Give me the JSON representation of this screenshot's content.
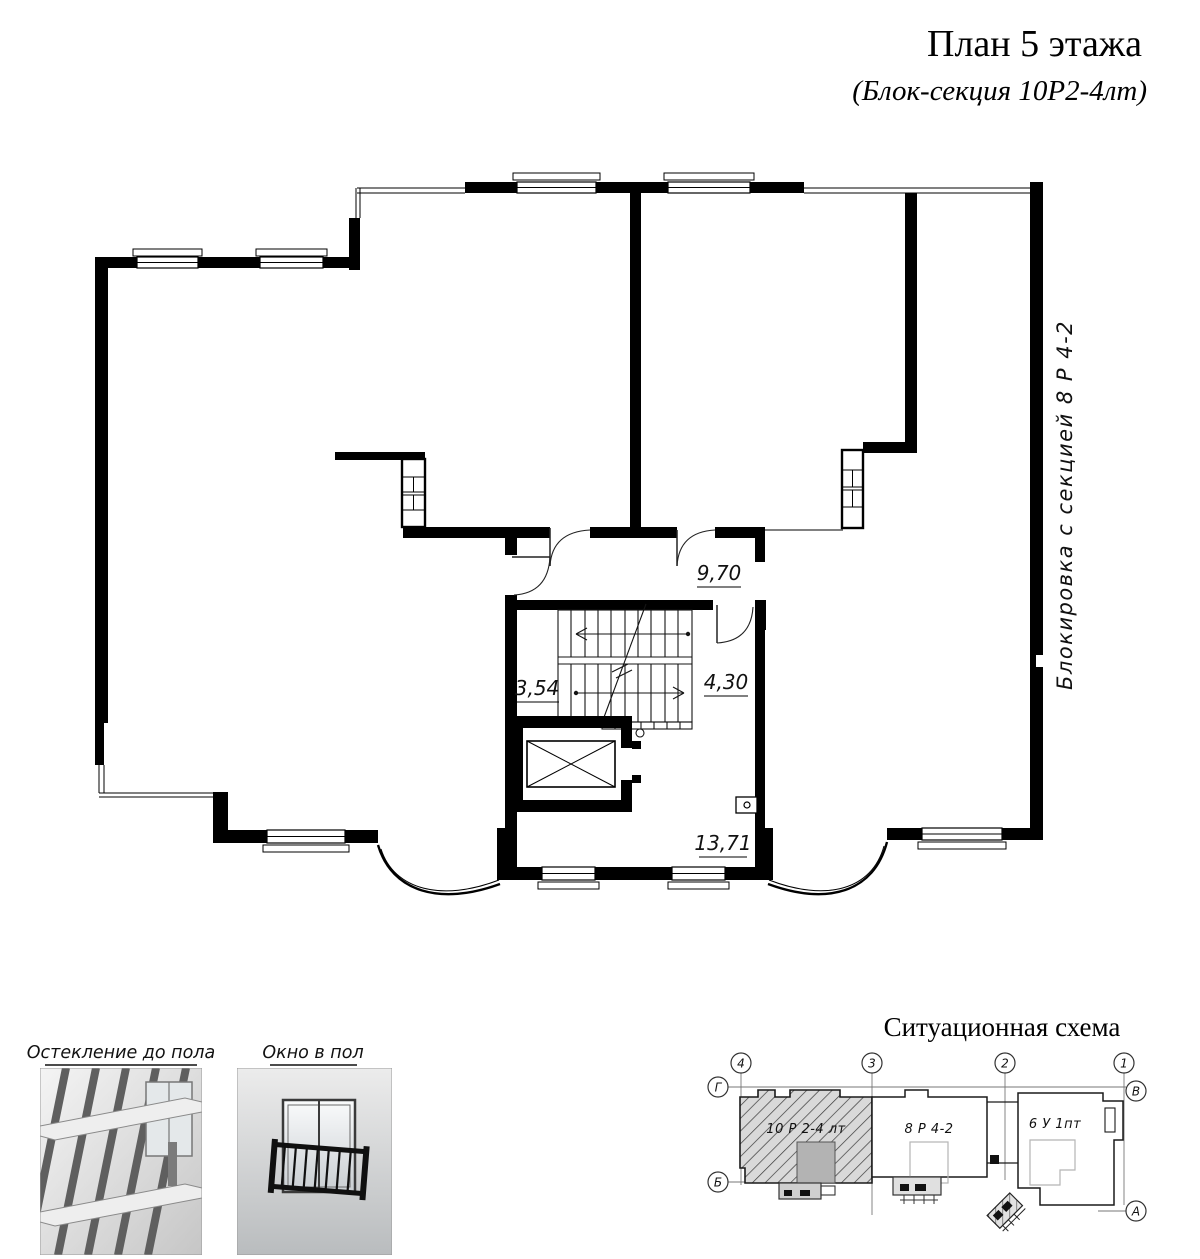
{
  "header": {
    "title": "План 5 этажа",
    "subtitle": "(Блок-секция 10Р2-4лт)"
  },
  "side_label": "Блокировка  с  секцией  8 Р 4-2",
  "floor_plan": {
    "dim_hall": "9,70",
    "dim_left": "3,54",
    "dim_stair": "4,30",
    "dim_room": "13,71"
  },
  "legend": {
    "glazing_caption": "Остекление до пола",
    "window_caption": "Окно в пол"
  },
  "scheme": {
    "title": "Ситуационная схема",
    "blocks": [
      {
        "label": "10 Р 2-4 лт",
        "highlighted": true
      },
      {
        "label": "8 Р 4-2",
        "highlighted": false
      },
      {
        "label": "6 У 1пт",
        "highlighted": false
      }
    ],
    "axis_columns": [
      "4",
      "3",
      "2",
      "1"
    ],
    "axis_left": [
      "Г",
      "Б"
    ],
    "axis_right": [
      "В",
      "А"
    ]
  },
  "colors": {
    "wall": "#000000",
    "hatch_fill": "#d9d9d9",
    "core_gray": "#b3b3b3"
  }
}
